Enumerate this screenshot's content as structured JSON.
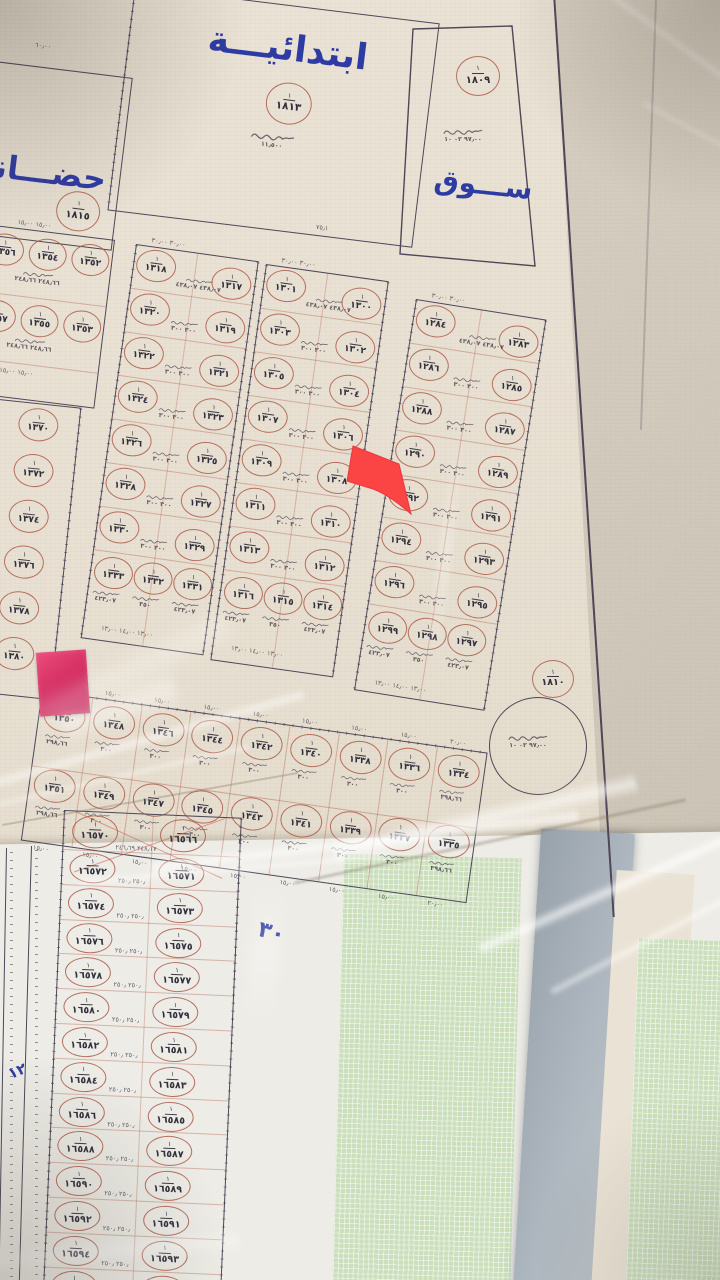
{
  "numerator": "١",
  "facilities": {
    "school": {
      "label": "ابتدائيـــة",
      "plot": "١٨١٣",
      "note": "١١٫٥٠٠",
      "bottom_dim": "٧٥٫١"
    },
    "nursery": {
      "label": "حضـــانة",
      "plot": "١٨١٥",
      "top_dim": "٦٠٫٠٠"
    },
    "market": {
      "label": "ســـوق",
      "plot": "١٨٠٩",
      "note": "٩٧٫٠٠  ٠٢  ١٠"
    },
    "roundabout": {
      "plot": "١٨١٠",
      "note": "٩٧٫٠٠  ٠٢  ١٠"
    }
  },
  "street_labels": {
    "thirty": "٣٠",
    "twelve": "١٢"
  },
  "upper_blocks": {
    "A1": {
      "rows": [
        [
          "١٣٥٦",
          "١٣٥٤",
          "١٣٥٢"
        ],
        [
          "١٣٥٧",
          "١٣٥٥",
          "١٣٥٣"
        ]
      ],
      "row_note": "٢٤٨٫٦٦  ٢٤٨٫٦٦",
      "top_dims": "١٥٫٠٠   ١٥٫٠٠",
      "bottom_dims": "١٥٫٠٠   ١٥٫٠٠"
    },
    "A2": {
      "plots": [
        "١٣٧٠",
        "١٣٧٢",
        "١٣٧٤",
        "١٣٧٦",
        "١٣٧٨",
        "١٣٨٠"
      ],
      "first_note": "٢٤٨٫٦٦",
      "pair_note": "٣٠٠"
    },
    "B": {
      "top_dims": "٣٠٫٠٠        ٣٠٫٠٠",
      "first_note": "٤٣٨٫٠٧ ٤٣٨٫٠٧",
      "pair_note": "٣٠٠  ٣٠٠",
      "left": [
        "١٣١٨",
        "١٣٢٠",
        "١٣٢٢",
        "١٣٢٤",
        "١٣٢٦",
        "١٣٢٨",
        "١٣٣٠"
      ],
      "right": [
        "١٣١٧",
        "١٣١٩",
        "١٣٢١",
        "١٣٢٣",
        "١٣٢٥",
        "١٣٢٧",
        "١٣٢٩"
      ],
      "bottom": [
        "١٣٣٣",
        "١٣٣٢",
        "١٣٣١"
      ],
      "bottom_notes": [
        "٤٢٣٫٠٧",
        "٣٥٠",
        "٤٢٣٫٠٧"
      ],
      "bottom_dims": "١٣٫٠٠  ١٤٫٠٠  ١٣٫٠٠"
    },
    "C": {
      "top_dims": "٣٠٫٠٠        ٣٠٫٠٠",
      "first_note": "٤٣٨٫٠٧ ٤٣٨٫٠٧",
      "pair_note": "٣٠٠  ٣٠٠",
      "left": [
        "١٣٠١",
        "١٣٠٣",
        "١٣٠٥",
        "١٣٠٧",
        "١٣٠٩",
        "١٣١١",
        "١٣١٣"
      ],
      "right": [
        "١٣٠٠",
        "١٣٠٢",
        "١٣٠٤",
        "١٣٠٦",
        "١٣٠٨",
        "١٣١٠",
        "١٣١٢"
      ],
      "bottom": [
        "١٣١٦",
        "١٣١٥",
        "١٣١٤"
      ],
      "bottom_notes": [
        "٤٢٣٫٠٧",
        "٣٥٠",
        "٤٢٣٫٠٧"
      ],
      "bottom_dims": "١٣٫٠٠  ١٤٫٠٠  ١٣٫٠٠"
    },
    "D": {
      "top_dims": "٣٠٫٠٠        ٣٠٫٠٠",
      "first_note": "٤٣٨٫٠٧ ٤٣٨٫٠٧",
      "pair_note": "٣٠٠  ٣٠٠",
      "left": [
        "١٢٨٤",
        "١٢٨٦",
        "١٢٨٨",
        "١٢٩٠",
        "١٢٩٢",
        "١٢٩٤",
        "١٢٩٦"
      ],
      "right": [
        "١٢٨٣",
        "١٢٨٥",
        "١٢٨٧",
        "١٢٨٩",
        "١٢٩١",
        "١٢٩٣",
        "١٢٩٥"
      ],
      "bottom": [
        "١٢٩٩",
        "١٢٩٨",
        "١٢٩٧"
      ],
      "bottom_notes": [
        "٤٢٣٫٠٧",
        "٣٥٠",
        "٤٢٣٫٠٧"
      ],
      "bottom_dims": "١٣٫٠٠  ١٤٫٠٠  ١٣٫٠٠"
    }
  },
  "strip_block": {
    "top_row": [
      "١٣٥٠",
      "١٣٤٨",
      "١٣٤٦",
      "١٣٤٤",
      "١٣٤٢",
      "١٣٤٠",
      "١٣٣٨",
      "١٣٣٦",
      "١٣٣٤"
    ],
    "bottom_row": [
      "١٣٥١",
      "١٣٤٩",
      "١٣٤٧",
      "١٣٤٥",
      "١٣٤٣",
      "١٣٤١",
      "١٣٣٩",
      "١٣٣٧",
      "١٣٣٥"
    ],
    "col_notes": [
      "٢٩٨٫٦٦",
      "٣٠٠",
      "٣٠٠",
      "٣٠٠",
      "٣٠٠",
      "٣٠٠",
      "٣٠٠",
      "٣٠٠",
      "٣٩٨٫٦٦"
    ],
    "top_dims": [
      "١٥٫٠٠",
      "١٥٫٠٠",
      "١٥٫٠٠",
      "١٥٫٠٠",
      "١٥٫٠٠",
      "١٥٫٠٠",
      "١٥٫٠٠",
      "١٥٫٠٠",
      "٢٠٫٠٠"
    ],
    "bottom_dims": [
      "١٥٫٠٠",
      "١٥٫٠٠",
      "١٥٫٠٠",
      "١٥٫٠٠",
      "١٥٫٠٠",
      "١٥٫٠٠",
      "١٥٫٠٠",
      "١٥٫٠٠",
      "٢٠٫٠٠"
    ]
  },
  "lower_block": {
    "header": [
      "١٦٥٧٠",
      "١٦٥٦٦"
    ],
    "header_note": "٢٤٨٫١٧  ٢٤٦٫٦٩",
    "pair_note": "٢٥٠٫  ٢٥٠٫",
    "pairs": [
      [
        "١٦٥٧٢",
        "١٦٥٧١"
      ],
      [
        "١٦٥٧٤",
        "١٦٥٧٣"
      ],
      [
        "١٦٥٧٦",
        "١٦٥٧٥"
      ],
      [
        "١٦٥٧٨",
        "١٦٥٧٧"
      ],
      [
        "١٦٥٨٠",
        "١٦٥٧٩"
      ],
      [
        "١٦٥٨٢",
        "١٦٥٨١"
      ],
      [
        "١٦٥٨٤",
        "١٦٥٨٣"
      ],
      [
        "١٦٥٨٦",
        "١٦٥٨٥"
      ],
      [
        "١٦٥٨٨",
        "١٦٥٨٧"
      ],
      [
        "١٦٥٩٠",
        "١٦٥٨٩"
      ],
      [
        "١٦٥٩٢",
        "١٦٥٩١"
      ],
      [
        "١٦٥٩٤",
        "١٦٥٩٣"
      ],
      [
        "١٦٥٩٦",
        "١٦٥٩٥"
      ]
    ]
  }
}
